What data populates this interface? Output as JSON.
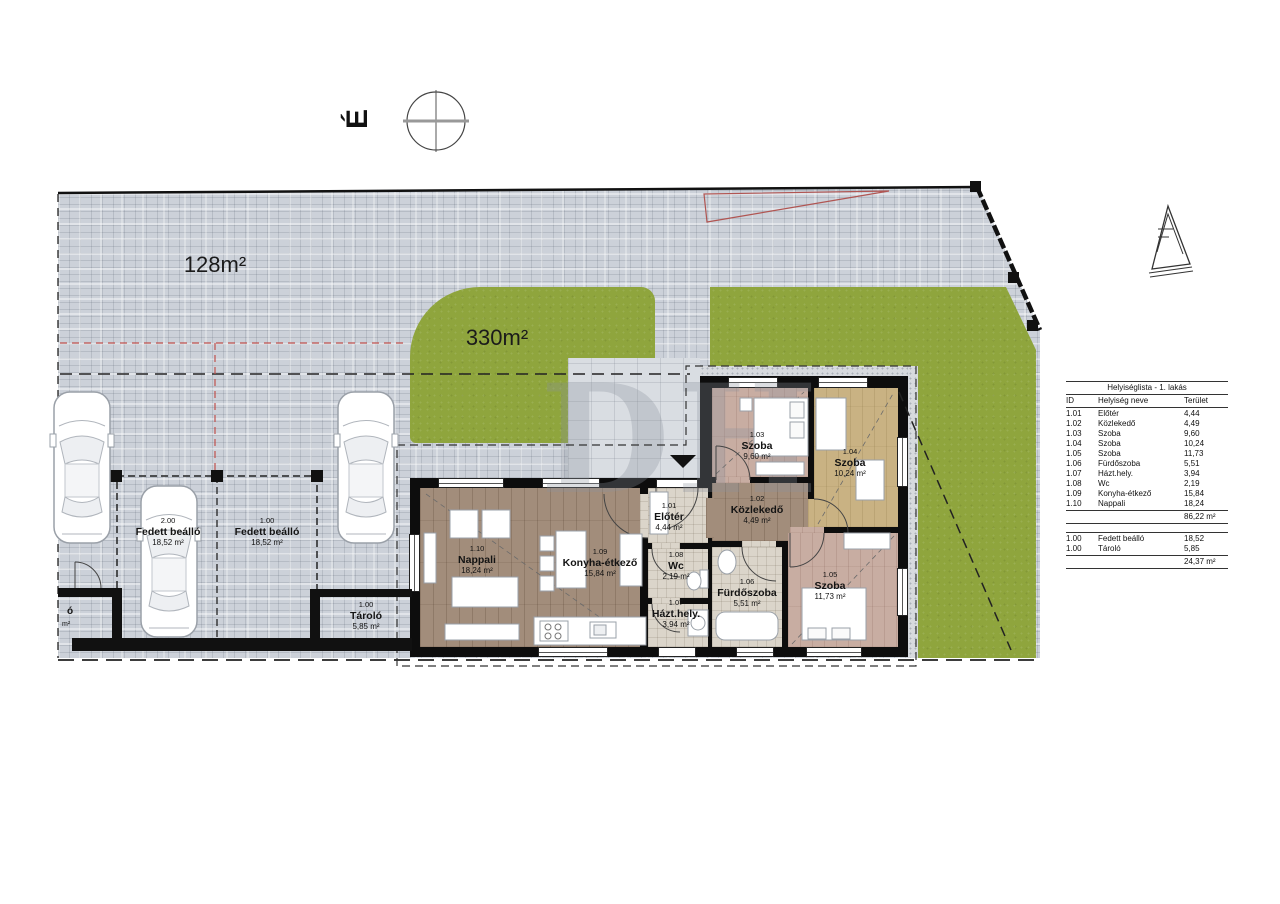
{
  "north_letter": "É",
  "watermark": "DH",
  "area_labels": {
    "paved": "128m²",
    "lawn": "330m²"
  },
  "edge_fragment": {
    "top": "ó",
    "bottom": "m²"
  },
  "plan_rooms": [
    {
      "id": "1.10",
      "name": "Nappali",
      "area": "18,24 m²"
    },
    {
      "id": "1.09",
      "name": "Konyha-étkező",
      "area": "15,84 m²"
    },
    {
      "id": "1.01",
      "name": "Előtér",
      "area": "4,44 m²"
    },
    {
      "id": "1.08",
      "name": "Wc",
      "area": "2,19 m²"
    },
    {
      "id": "1.07",
      "name": "Házt.hely.",
      "area": "3,94 m²"
    },
    {
      "id": "1.02",
      "name": "Közlekedő",
      "area": "4,49 m²"
    },
    {
      "id": "1.06",
      "name": "Fürdőszoba",
      "area": "5,51 m²"
    },
    {
      "id": "1.03",
      "name": "Szoba",
      "area": "9,60 m²"
    },
    {
      "id": "1.04",
      "name": "Szoba",
      "area": "10,24 m²"
    },
    {
      "id": "1.05",
      "name": "Szoba",
      "area": "11,73 m²"
    }
  ],
  "outdoor_rooms": [
    {
      "id": "2.00",
      "name": "Fedett beálló",
      "area": "18,52 m²"
    },
    {
      "id": "1.00",
      "name": "Fedett beálló",
      "area": "18,52 m²"
    },
    {
      "id": "1.00",
      "name": "Tároló",
      "area": "5,85 m²"
    }
  ],
  "room_list_table": {
    "title": "Helyiséglista - 1. lakás",
    "columns": [
      "ID",
      "Helyiség neve",
      "Terület"
    ],
    "rows": [
      [
        "1.01",
        "Előtér",
        "4,44"
      ],
      [
        "1.02",
        "Közlekedő",
        "4,49"
      ],
      [
        "1.03",
        "Szoba",
        "9,60"
      ],
      [
        "1.04",
        "Szoba",
        "10,24"
      ],
      [
        "1.05",
        "Szoba",
        "11,73"
      ],
      [
        "1.06",
        "Fürdőszoba",
        "5,51"
      ],
      [
        "1.07",
        "Házt.hely.",
        "3,94"
      ],
      [
        "1.08",
        "Wc",
        "2,19"
      ],
      [
        "1.09",
        "Konyha-étkező",
        "15,84"
      ],
      [
        "1.10",
        "Nappali",
        "18,24"
      ]
    ],
    "subtotal_main": "86,22 m²",
    "rows_outdoor": [
      [
        "1.00",
        "Fedett beálló",
        "18,52"
      ],
      [
        "1.00",
        "Tároló",
        "5,85"
      ]
    ],
    "subtotal_outdoor": "24,37 m²"
  }
}
